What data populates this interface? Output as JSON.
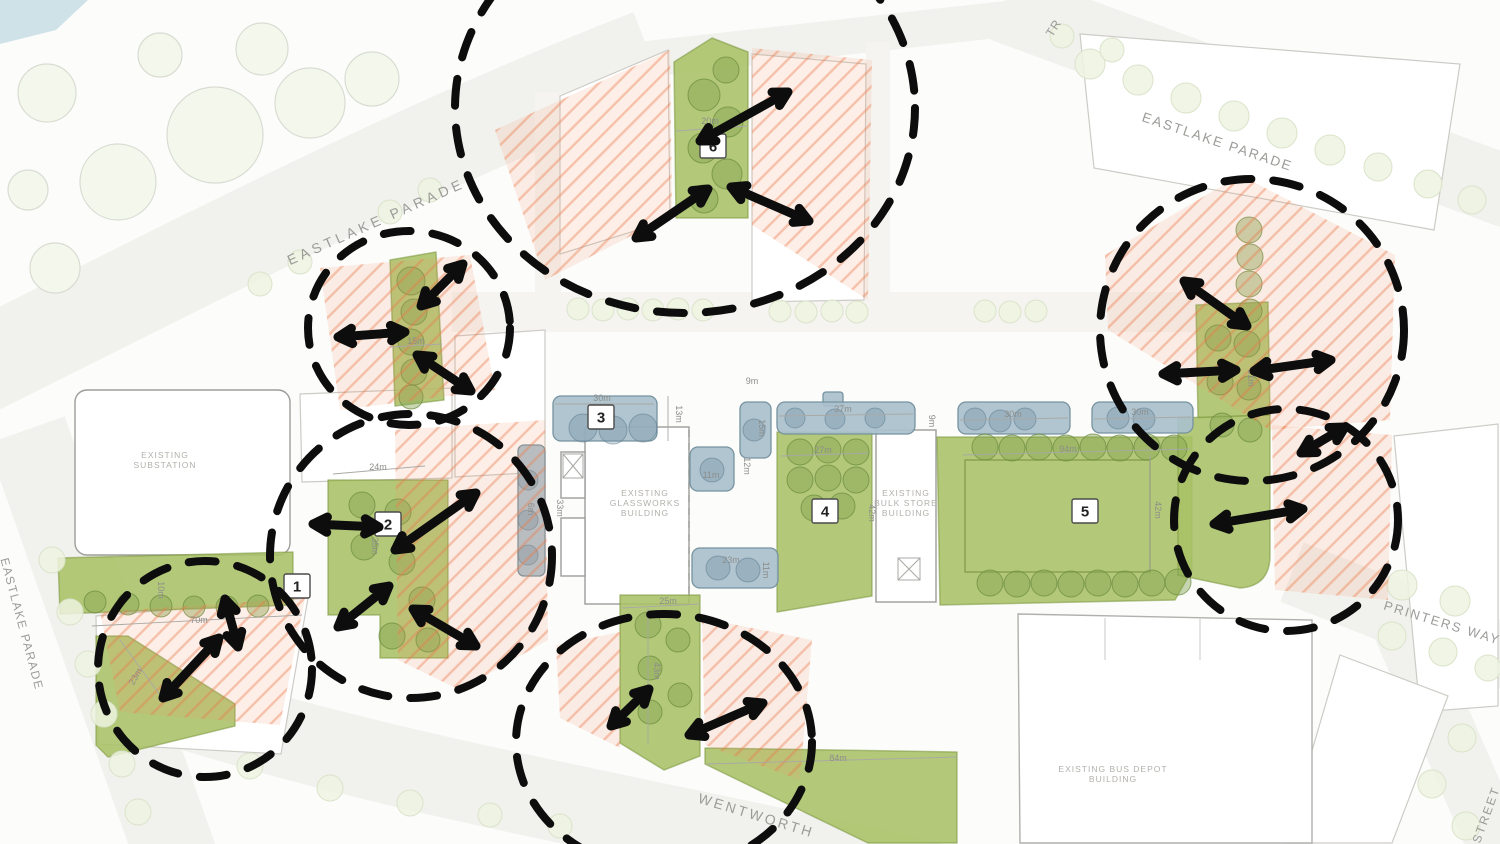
{
  "colors": {
    "open_space_green": "#a8c167",
    "proposed_building_blue": "#a9c0cc",
    "solar_hatch_orange": "#ee8a5e",
    "annotation_black": "#0d0d0d",
    "street_label_grey": "#9b9b98",
    "water_blue": "#cfe2e8"
  },
  "street_labels": [
    {
      "id": "eastlake-parade-nw",
      "text": "EASTLAKE  PARADE",
      "x": 378,
      "y": 226,
      "rotate": -24,
      "size": 14,
      "spacing": 4
    },
    {
      "id": "eastlake-parade-ne",
      "text": "EASTLAKE PARADE",
      "x": 1216,
      "y": 146,
      "rotate": 18.5,
      "size": 13.5,
      "spacing": 2
    },
    {
      "id": "eastlake-parade-w",
      "text": "EASTLAKE PARADE",
      "x": 18,
      "y": 625,
      "rotate": 75,
      "size": 12,
      "spacing": 1.5
    },
    {
      "id": "printers-way",
      "text": "PRINTERS WAY",
      "x": 1441,
      "y": 627,
      "rotate": 17,
      "size": 13,
      "spacing": 2
    },
    {
      "id": "wentworth",
      "text": "WENTWORTH",
      "x": 755,
      "y": 820,
      "rotate": 17,
      "size": 14,
      "spacing": 3
    },
    {
      "id": "street",
      "text": "STREET",
      "x": 1490,
      "y": 816,
      "rotate": -70,
      "size": 12,
      "spacing": 2
    },
    {
      "id": "tr-partial",
      "text": "TR",
      "x": 1057,
      "y": 30,
      "rotate": -58,
      "size": 12,
      "spacing": 1
    }
  ],
  "building_labels": [
    {
      "id": "substation",
      "lines": [
        "EXISTING",
        "SUBSTATION"
      ],
      "x": 165,
      "y": 458
    },
    {
      "id": "glassworks",
      "lines": [
        "EXISTING",
        "GLASSWORKS",
        "BUILDING"
      ],
      "x": 645,
      "y": 496
    },
    {
      "id": "bulk-store",
      "lines": [
        "EXISTING",
        "BULK STORE",
        "BUILDING"
      ],
      "x": 906,
      "y": 496
    },
    {
      "id": "bus-depot",
      "lines": [
        "EXISTING BUS DEPOT",
        "BUILDING"
      ],
      "x": 1113,
      "y": 772
    }
  ],
  "space_markers": [
    {
      "num": "1",
      "x": 297,
      "y": 586
    },
    {
      "num": "2",
      "x": 388,
      "y": 524
    },
    {
      "num": "3",
      "x": 601,
      "y": 417
    },
    {
      "num": "4",
      "x": 825,
      "y": 511
    },
    {
      "num": "5",
      "x": 1085,
      "y": 511
    },
    {
      "num": "6",
      "x": 713,
      "y": 146
    }
  ],
  "dimensions": [
    {
      "text": "20m",
      "x": 710,
      "y": 124,
      "r": 0
    },
    {
      "text": "15m",
      "x": 416,
      "y": 344,
      "r": 0
    },
    {
      "text": "30m",
      "x": 602,
      "y": 401,
      "r": 0
    },
    {
      "text": "13m",
      "x": 676,
      "y": 414,
      "r": 90
    },
    {
      "text": "9m",
      "x": 752,
      "y": 384,
      "r": 0
    },
    {
      "text": "15m",
      "x": 759,
      "y": 428,
      "r": 90
    },
    {
      "text": "12m",
      "x": 744,
      "y": 466,
      "r": 90
    },
    {
      "text": "11m",
      "x": 711,
      "y": 478,
      "r": 0
    },
    {
      "text": "37m",
      "x": 843,
      "y": 412,
      "r": 0
    },
    {
      "text": "9m",
      "x": 929,
      "y": 421,
      "r": 90
    },
    {
      "text": "27m",
      "x": 823,
      "y": 453,
      "r": 0
    },
    {
      "text": "42m",
      "x": 869,
      "y": 513,
      "r": 90
    },
    {
      "text": "23m",
      "x": 731,
      "y": 563,
      "r": 0
    },
    {
      "text": "11m",
      "x": 763,
      "y": 570,
      "r": 90
    },
    {
      "text": "30m",
      "x": 1013,
      "y": 417,
      "r": 0
    },
    {
      "text": "30m",
      "x": 1140,
      "y": 415,
      "r": 0
    },
    {
      "text": "94m",
      "x": 1068,
      "y": 452,
      "r": 0
    },
    {
      "text": "42m",
      "x": 1155,
      "y": 510,
      "r": 90
    },
    {
      "text": "31m",
      "x": 1248,
      "y": 378,
      "r": 90
    },
    {
      "text": "24m",
      "x": 378,
      "y": 470,
      "r": 0
    },
    {
      "text": "35m",
      "x": 372,
      "y": 546,
      "r": 90
    },
    {
      "text": "6m",
      "x": 528,
      "y": 509,
      "r": 90
    },
    {
      "text": "33m",
      "x": 557,
      "y": 508,
      "r": 90
    },
    {
      "text": "10m",
      "x": 158,
      "y": 590,
      "r": 90
    },
    {
      "text": "70m",
      "x": 199,
      "y": 623,
      "r": 0
    },
    {
      "text": "23m",
      "x": 138,
      "y": 678,
      "r": -60
    },
    {
      "text": "25m",
      "x": 668,
      "y": 604,
      "r": 0
    },
    {
      "text": "43m",
      "x": 654,
      "y": 671,
      "r": 90
    },
    {
      "text": "84m",
      "x": 838,
      "y": 761,
      "r": 0
    }
  ],
  "annotations": {
    "circles": [
      {
        "cx": 685,
        "cy": 108,
        "rx": 230,
        "ry": 205
      },
      {
        "cx": 409,
        "cy": 328,
        "rx": 101,
        "ry": 97
      },
      {
        "cx": 411,
        "cy": 556,
        "rx": 141,
        "ry": 142
      },
      {
        "cx": 205,
        "cy": 669,
        "rx": 107,
        "ry": 108
      },
      {
        "cx": 664,
        "cy": 742,
        "rx": 148,
        "ry": 128
      },
      {
        "cx": 1252,
        "cy": 330,
        "rx": 152,
        "ry": 151
      },
      {
        "cx": 1286,
        "cy": 520,
        "rx": 112,
        "ry": 111
      }
    ],
    "arrows": [
      {
        "x1": 700,
        "y1": 141,
        "x2": 788,
        "y2": 92
      },
      {
        "x1": 636,
        "y1": 238,
        "x2": 708,
        "y2": 189
      },
      {
        "x1": 731,
        "y1": 187,
        "x2": 809,
        "y2": 221
      },
      {
        "x1": 421,
        "y1": 306,
        "x2": 463,
        "y2": 264
      },
      {
        "x1": 338,
        "y1": 337,
        "x2": 405,
        "y2": 332
      },
      {
        "x1": 417,
        "y1": 355,
        "x2": 471,
        "y2": 391
      },
      {
        "x1": 313,
        "y1": 524,
        "x2": 379,
        "y2": 527
      },
      {
        "x1": 395,
        "y1": 550,
        "x2": 476,
        "y2": 493
      },
      {
        "x1": 338,
        "y1": 627,
        "x2": 389,
        "y2": 586
      },
      {
        "x1": 413,
        "y1": 609,
        "x2": 476,
        "y2": 646
      },
      {
        "x1": 163,
        "y1": 698,
        "x2": 219,
        "y2": 638
      },
      {
        "x1": 225,
        "y1": 599,
        "x2": 238,
        "y2": 647
      },
      {
        "x1": 611,
        "y1": 726,
        "x2": 649,
        "y2": 689
      },
      {
        "x1": 689,
        "y1": 735,
        "x2": 763,
        "y2": 703
      },
      {
        "x1": 1184,
        "y1": 281,
        "x2": 1247,
        "y2": 326
      },
      {
        "x1": 1163,
        "y1": 374,
        "x2": 1236,
        "y2": 370
      },
      {
        "x1": 1254,
        "y1": 371,
        "x2": 1331,
        "y2": 360
      },
      {
        "x1": 1301,
        "y1": 453,
        "x2": 1345,
        "y2": 427
      },
      {
        "x1": 1214,
        "y1": 524,
        "x2": 1303,
        "y2": 509
      }
    ]
  }
}
